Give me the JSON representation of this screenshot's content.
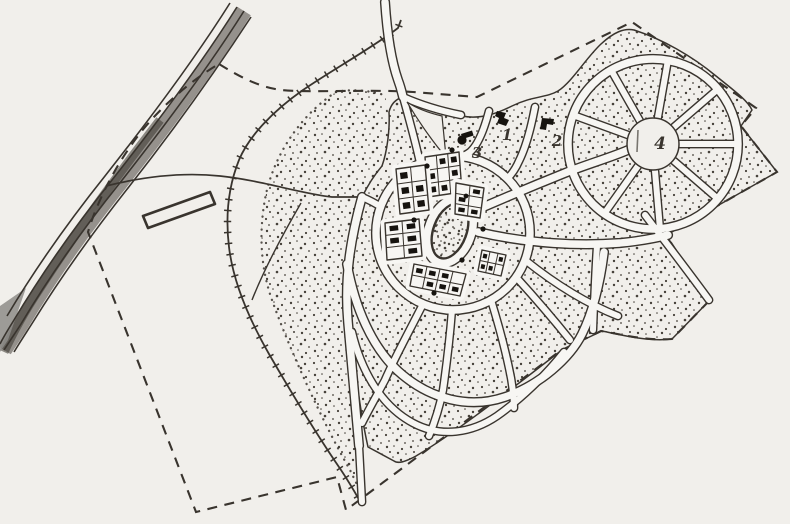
{
  "figure": {
    "kind": "scanned hand-drawn town plan map",
    "description": "organic street network around an oval park and a circular plaza, railway, river road, dashed site boundary"
  },
  "labels": {
    "area1": "1",
    "area2": "2",
    "area3": "3",
    "area4": "4"
  },
  "colors": {
    "paper": "#f1efeb",
    "street": "#f7f6f3",
    "ink": "#39342e",
    "stipple": "#46413a",
    "building": "#16130f",
    "wash_light": "#c6c5c1",
    "wash_dark": "#8e8c88"
  }
}
